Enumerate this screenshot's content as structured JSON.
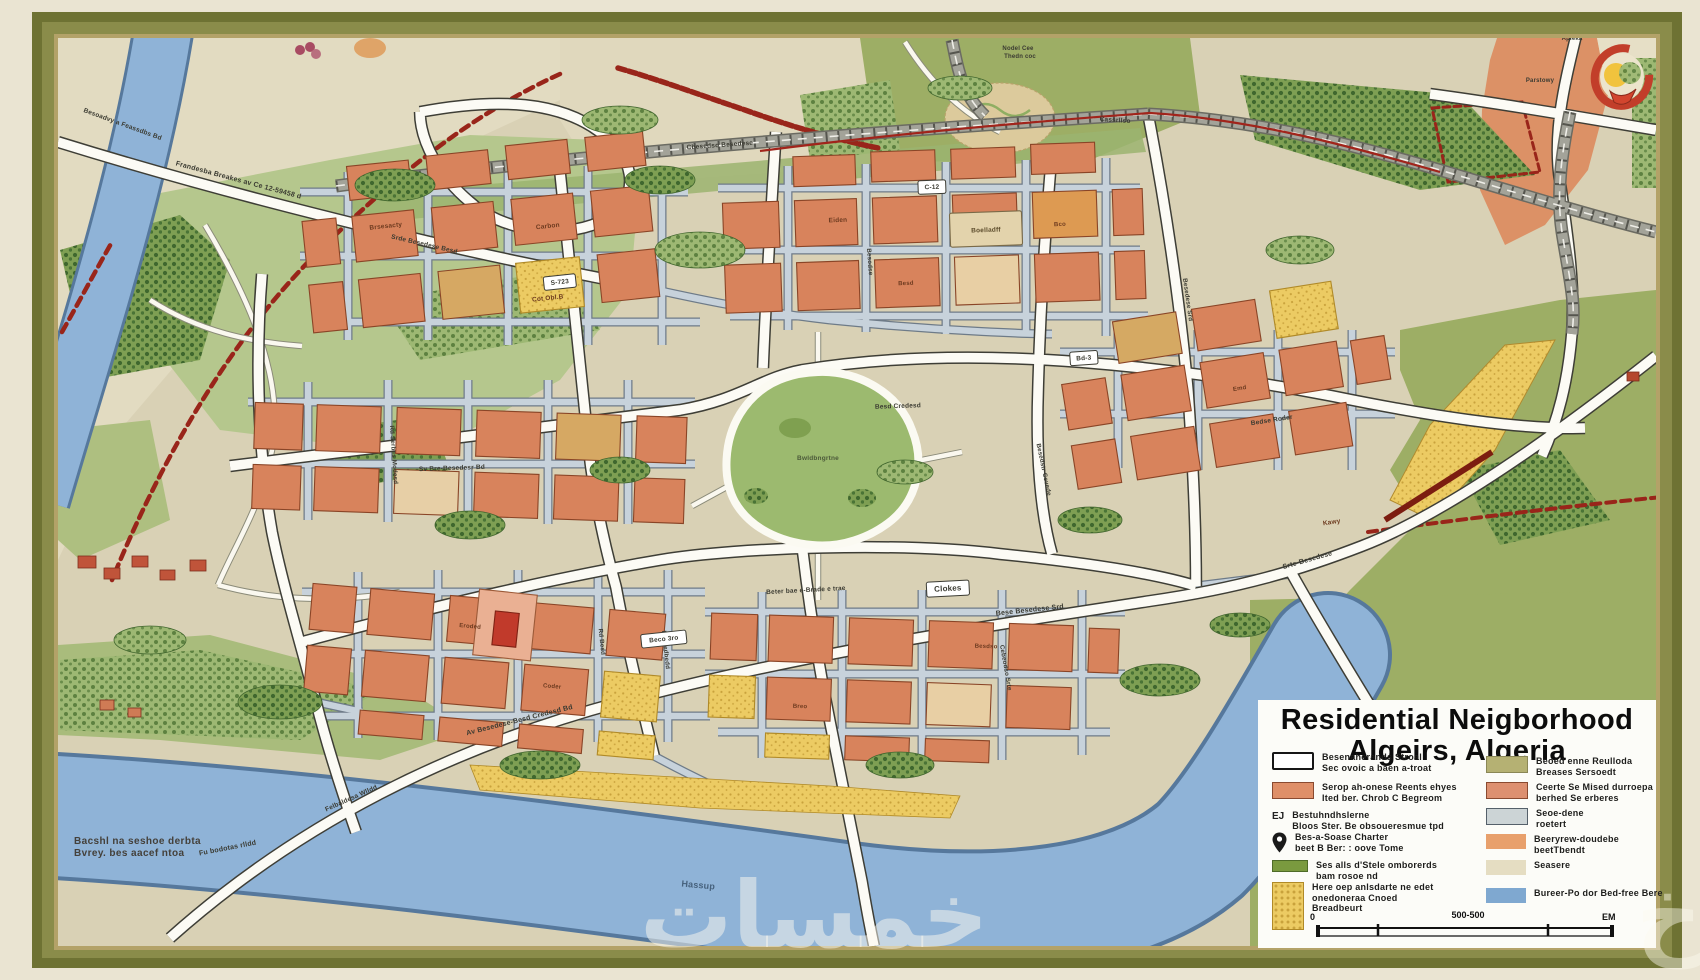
{
  "legend": {
    "title1": "Residential Neigborhood",
    "title2": "Algeirs, Algeria",
    "left_items": [
      {
        "type": "outline",
        "color": "#ffffff",
        "lines": [
          "Besenaherands Stroal",
          "Sec ovoic a baen a-troat"
        ]
      },
      {
        "type": "fill",
        "color": "#df8f68",
        "border": "#8a4a30",
        "lines": [
          "Serop ah-onese Reents ehyes",
          "Ited ber. Chrob C Begreom"
        ]
      },
      {
        "type": "text",
        "label": "EJ",
        "lines": [
          "Bestuhndhslerne",
          "Bloos Ster. Be obsoueresmue tpd"
        ]
      },
      {
        "type": "pin",
        "lines": [
          "Bes-a-Soase Charter",
          "beet B Ber: : oove Tome"
        ]
      },
      {
        "type": "bar",
        "color": "#7a9a3f",
        "border": "#4e6b28",
        "lines": [
          "Ses alls d'Stele omborerds",
          "bam rosoe nd"
        ]
      },
      {
        "type": "dots",
        "lines": [
          "Here oep anlsdarte ne edet",
          "onedoneraa Cnoed",
          "Breadbeurt"
        ]
      }
    ],
    "right_items": [
      {
        "type": "fill",
        "color": "#b5b173",
        "border": "#8a8756",
        "lines": [
          "Beoed enne Reulloda",
          "Breases Sersoedt"
        ]
      },
      {
        "type": "fill",
        "color": "#dd9070",
        "border": "#8a4a30",
        "lines": [
          "Ceerte Se Mised durroepa",
          "berhed Se erberes"
        ]
      },
      {
        "type": "fill",
        "color": "#ccd4d6",
        "border": "#55606a",
        "lines": [
          "Seoe-dene",
          "roetert"
        ]
      },
      {
        "type": "fill",
        "color": "#e8a06c",
        "lines": [
          "Beeryrew-doudebe",
          "beetTbendt"
        ]
      },
      {
        "type": "fill",
        "color": "#e5ddc2",
        "lines": [
          "Seasere"
        ]
      },
      {
        "type": "fill",
        "color": "#7fa8d0",
        "lines": [
          "Bureer-Po dor Bed-free Bere"
        ]
      }
    ],
    "scale": {
      "left": "0",
      "mid": "500-500",
      "right": "EM"
    }
  },
  "credits": {
    "line1": "Bacshl na seshoe derbta",
    "line2": "Bvrey. bes aacef ntoa"
  },
  "watermark": {
    "text": "خمسات",
    "partial": "خ"
  },
  "labels": [
    {
      "t": "Frandesba Breakes av Ce 12-59458 d",
      "x": 238,
      "y": 182,
      "r": 15,
      "s": 7
    },
    {
      "t": "Besoadvy a Feassdbs Bd",
      "x": 122,
      "y": 126,
      "r": 20,
      "s": 6.5
    },
    {
      "t": "Nodel Cee",
      "x": 1018,
      "y": 50,
      "r": 0,
      "s": 6
    },
    {
      "t": "Thedn coc",
      "x": 1020,
      "y": 58,
      "r": 0,
      "s": 6
    },
    {
      "t": "Mocae.",
      "x": 1640,
      "y": 38,
      "r": 0,
      "s": 7,
      "c": "#4a5537"
    },
    {
      "t": "Apleka",
      "x": 1572,
      "y": 40,
      "r": 0,
      "s": 6
    },
    {
      "t": "Parstowy",
      "x": 1540,
      "y": 82,
      "r": 0,
      "s": 6
    },
    {
      "t": "Cbesedso Besedese",
      "x": 720,
      "y": 147,
      "r": -4,
      "s": 6.5
    },
    {
      "t": "Cassrllso",
      "x": 1115,
      "y": 122,
      "r": 4,
      "s": 6.5
    },
    {
      "t": "Bwldbngrtne",
      "x": 818,
      "y": 460,
      "r": 0,
      "s": 6.5,
      "c": "#4c5a3a"
    },
    {
      "t": "Hassup",
      "x": 698,
      "y": 888,
      "r": 5,
      "s": 9,
      "c": "#46617c"
    },
    {
      "t": "Fu bodotas rlldd",
      "x": 228,
      "y": 850,
      "r": -11,
      "s": 7
    },
    {
      "t": "Felbaldesa Wlldd",
      "x": 352,
      "y": 800,
      "r": -24,
      "s": 6.5
    },
    {
      "t": "Av Besedese-Besd Credesd Bd",
      "x": 520,
      "y": 722,
      "r": -14,
      "s": 7
    },
    {
      "t": "Bese Besedese Srd",
      "x": 1030,
      "y": 612,
      "r": -6,
      "s": 7
    },
    {
      "t": "Srte-Besedese",
      "x": 1308,
      "y": 562,
      "r": -16,
      "s": 7
    },
    {
      "t": "Beter bae e-Brade e trae",
      "x": 806,
      "y": 592,
      "r": -3,
      "s": 6.5
    },
    {
      "t": "Sv Bre-Besedesr Bd",
      "x": 452,
      "y": 470,
      "r": -2,
      "s": 6.5
    },
    {
      "t": "Besd Credesd",
      "x": 898,
      "y": 408,
      "r": -2,
      "s": 6.5
    },
    {
      "t": "Bedse Roder",
      "x": 1272,
      "y": 422,
      "r": -9,
      "s": 6.5
    },
    {
      "t": "Srde Besedese Besd",
      "x": 424,
      "y": 246,
      "r": 13,
      "s": 6.5
    },
    {
      "t": "Rd Serbes Modesd",
      "x": 392,
      "y": 455,
      "r": 86,
      "s": 6.2
    },
    {
      "t": "Beesedbedd",
      "x": 664,
      "y": 650,
      "r": 84,
      "s": 6.2
    },
    {
      "t": "Besedstr Cevede",
      "x": 1042,
      "y": 470,
      "r": 78,
      "s": 6.2
    },
    {
      "t": "Besodse",
      "x": 868,
      "y": 262,
      "r": 86,
      "s": 6.2
    },
    {
      "t": "Cebeodso Srte",
      "x": 1004,
      "y": 668,
      "r": 80,
      "s": 6.2
    },
    {
      "t": "Rd Besd",
      "x": 600,
      "y": 642,
      "r": 84,
      "s": 6.2
    },
    {
      "t": "Besedese Srd",
      "x": 1186,
      "y": 300,
      "r": 82,
      "s": 6.2
    },
    {
      "t": "Brsesacty",
      "x": 386,
      "y": 228,
      "r": -6,
      "s": 6.5,
      "c": "#6d3a1f"
    },
    {
      "t": "Carbon",
      "x": 548,
      "y": 228,
      "r": -6,
      "s": 6.5,
      "c": "#6d3a1f"
    },
    {
      "t": "Cot Obl.B",
      "x": 548,
      "y": 300,
      "r": -6,
      "s": 6.5,
      "c": "#6d3a1f"
    },
    {
      "t": "Eiden",
      "x": 838,
      "y": 222,
      "r": -2,
      "s": 6.5,
      "c": "#6d3a1f"
    },
    {
      "t": "Besd",
      "x": 906,
      "y": 285,
      "r": -2,
      "s": 6,
      "c": "#6d3a1f"
    },
    {
      "t": "Bco",
      "x": 1060,
      "y": 226,
      "r": -2,
      "s": 6,
      "c": "#6d3a1f"
    },
    {
      "t": "Emd",
      "x": 1240,
      "y": 390,
      "r": -9,
      "s": 6,
      "c": "#6d3a1f"
    },
    {
      "t": "Kawy",
      "x": 1332,
      "y": 524,
      "r": -9,
      "s": 6.5,
      "c": "#6d3a1f"
    },
    {
      "t": "Eroded",
      "x": 470,
      "y": 628,
      "r": 5,
      "s": 6,
      "c": "#6d3a1f"
    },
    {
      "t": "Coder",
      "x": 552,
      "y": 688,
      "r": 5,
      "s": 6,
      "c": "#6d3a1f"
    },
    {
      "t": "Breo",
      "x": 800,
      "y": 708,
      "r": 2,
      "s": 6,
      "c": "#6d3a1f"
    },
    {
      "t": "Besdso",
      "x": 986,
      "y": 648,
      "r": 2,
      "s": 6,
      "c": "#6d3a1f"
    },
    {
      "t": "Boelladff",
      "x": 986,
      "y": 232,
      "r": -2,
      "s": 6.5,
      "c": "#5a4a2a"
    },
    {
      "t": "S-723",
      "x": 560,
      "y": 284,
      "r": -6,
      "s": 6.5,
      "pill": 1
    },
    {
      "t": "Clokes",
      "x": 948,
      "y": 591,
      "r": -3,
      "s": 8,
      "pill": 1
    },
    {
      "t": "Bd-3",
      "x": 1084,
      "y": 360,
      "r": -4,
      "s": 6.5,
      "pill": 1
    },
    {
      "t": "C-12",
      "x": 932,
      "y": 189,
      "r": -2,
      "s": 6.5,
      "pill": 1
    },
    {
      "t": "Beco 3ro",
      "x": 664,
      "y": 641,
      "r": -6,
      "s": 6.5,
      "pill": 1
    }
  ],
  "colors": {
    "frame_olive": "#6e7233",
    "frame_gold": "#b3a268",
    "outer_cream": "#eae4d2",
    "map_tan": "#d9d1b5",
    "water": "#8fb3d7",
    "field_olive": "#9dae65",
    "park_green": "#b5c78d",
    "orchard_green": "#7e9f53",
    "building_orange": "#d8835c",
    "building_khaki": "#d6a863",
    "sand_yellow": "#eccb63",
    "street_blue": "#c7d2db",
    "road_white": "#fcfbf5",
    "rail_grey": "#a3a399",
    "boundary_red": "#99251a",
    "legend_bg": "#fcfcf8",
    "ink": "#1c1c1c"
  }
}
